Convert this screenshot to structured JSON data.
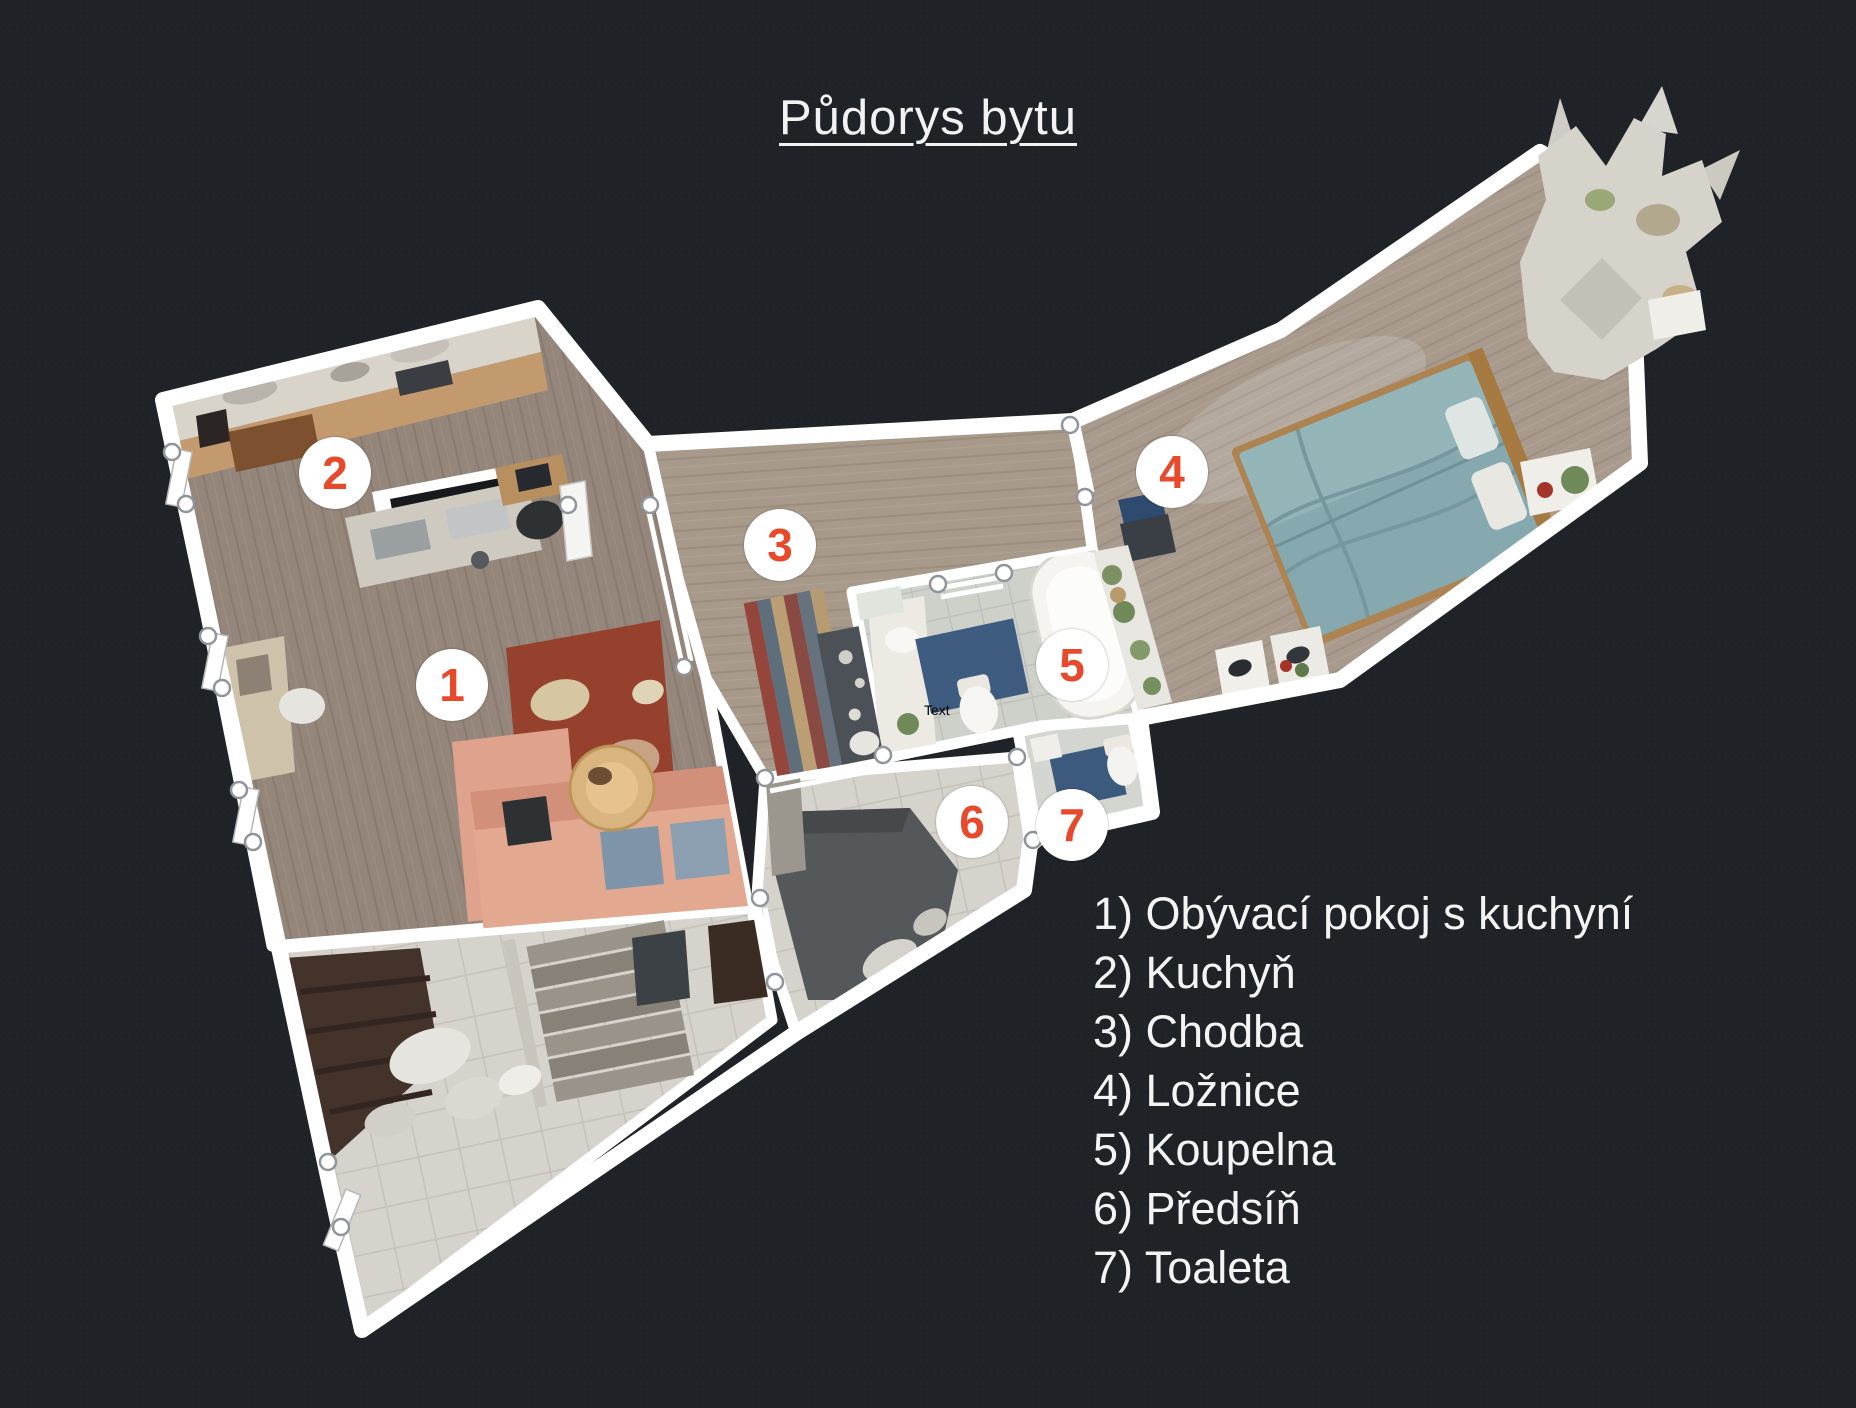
{
  "title": "Půdorys bytu",
  "legend": {
    "items": [
      {
        "text": "1) Obývací pokoj s kuchyní"
      },
      {
        "text": "2) Kuchyň"
      },
      {
        "text": "3) Chodba"
      },
      {
        "text": "4) Ložnice"
      },
      {
        "text": "5) Koupelna"
      },
      {
        "text": "6) Předsíň"
      },
      {
        "text": "7) Toaleta"
      }
    ]
  },
  "markers": [
    {
      "number": "1"
    },
    {
      "number": "2"
    },
    {
      "number": "3"
    },
    {
      "number": "4"
    },
    {
      "number": "5"
    },
    {
      "number": "6"
    },
    {
      "number": "7"
    }
  ],
  "floorplan": {
    "small_label": "Text"
  },
  "palette": {
    "background": "#1f2226",
    "wall": "#ffffff",
    "marker_circle": "#ffffff",
    "marker_number": "#e8492b",
    "legend_text": "#f4f4f4",
    "floor_wood": "#94867a",
    "floor_wood_light": "#a79a8b",
    "rug_red": "#96402e",
    "sofa_salmon": "#e2a890",
    "bed_teal": "#85a9ae",
    "mat_blue": "#3e5c7f"
  }
}
